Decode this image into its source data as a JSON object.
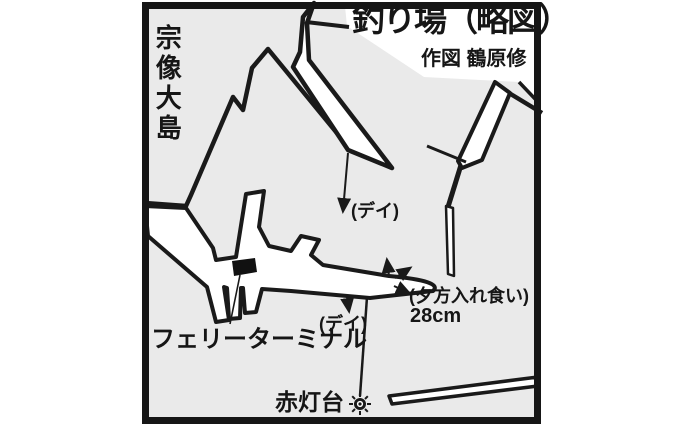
{
  "map": {
    "title": "釣り場（略図）",
    "credit": "作図 鶴原修",
    "labels": {
      "island": "宗像大島",
      "ferry_terminal": "フェリーターミナル",
      "red_lighthouse": "赤灯台",
      "day_spot_upper": "(デイ)",
      "day_spot_lower": "(デイ)",
      "evening_spot": "(夕方入れ食い)",
      "fish_size": "28cm"
    },
    "colors": {
      "terrain": "#eaeaea",
      "structures": "#ffffff",
      "ink": "#1a1a1a"
    }
  }
}
